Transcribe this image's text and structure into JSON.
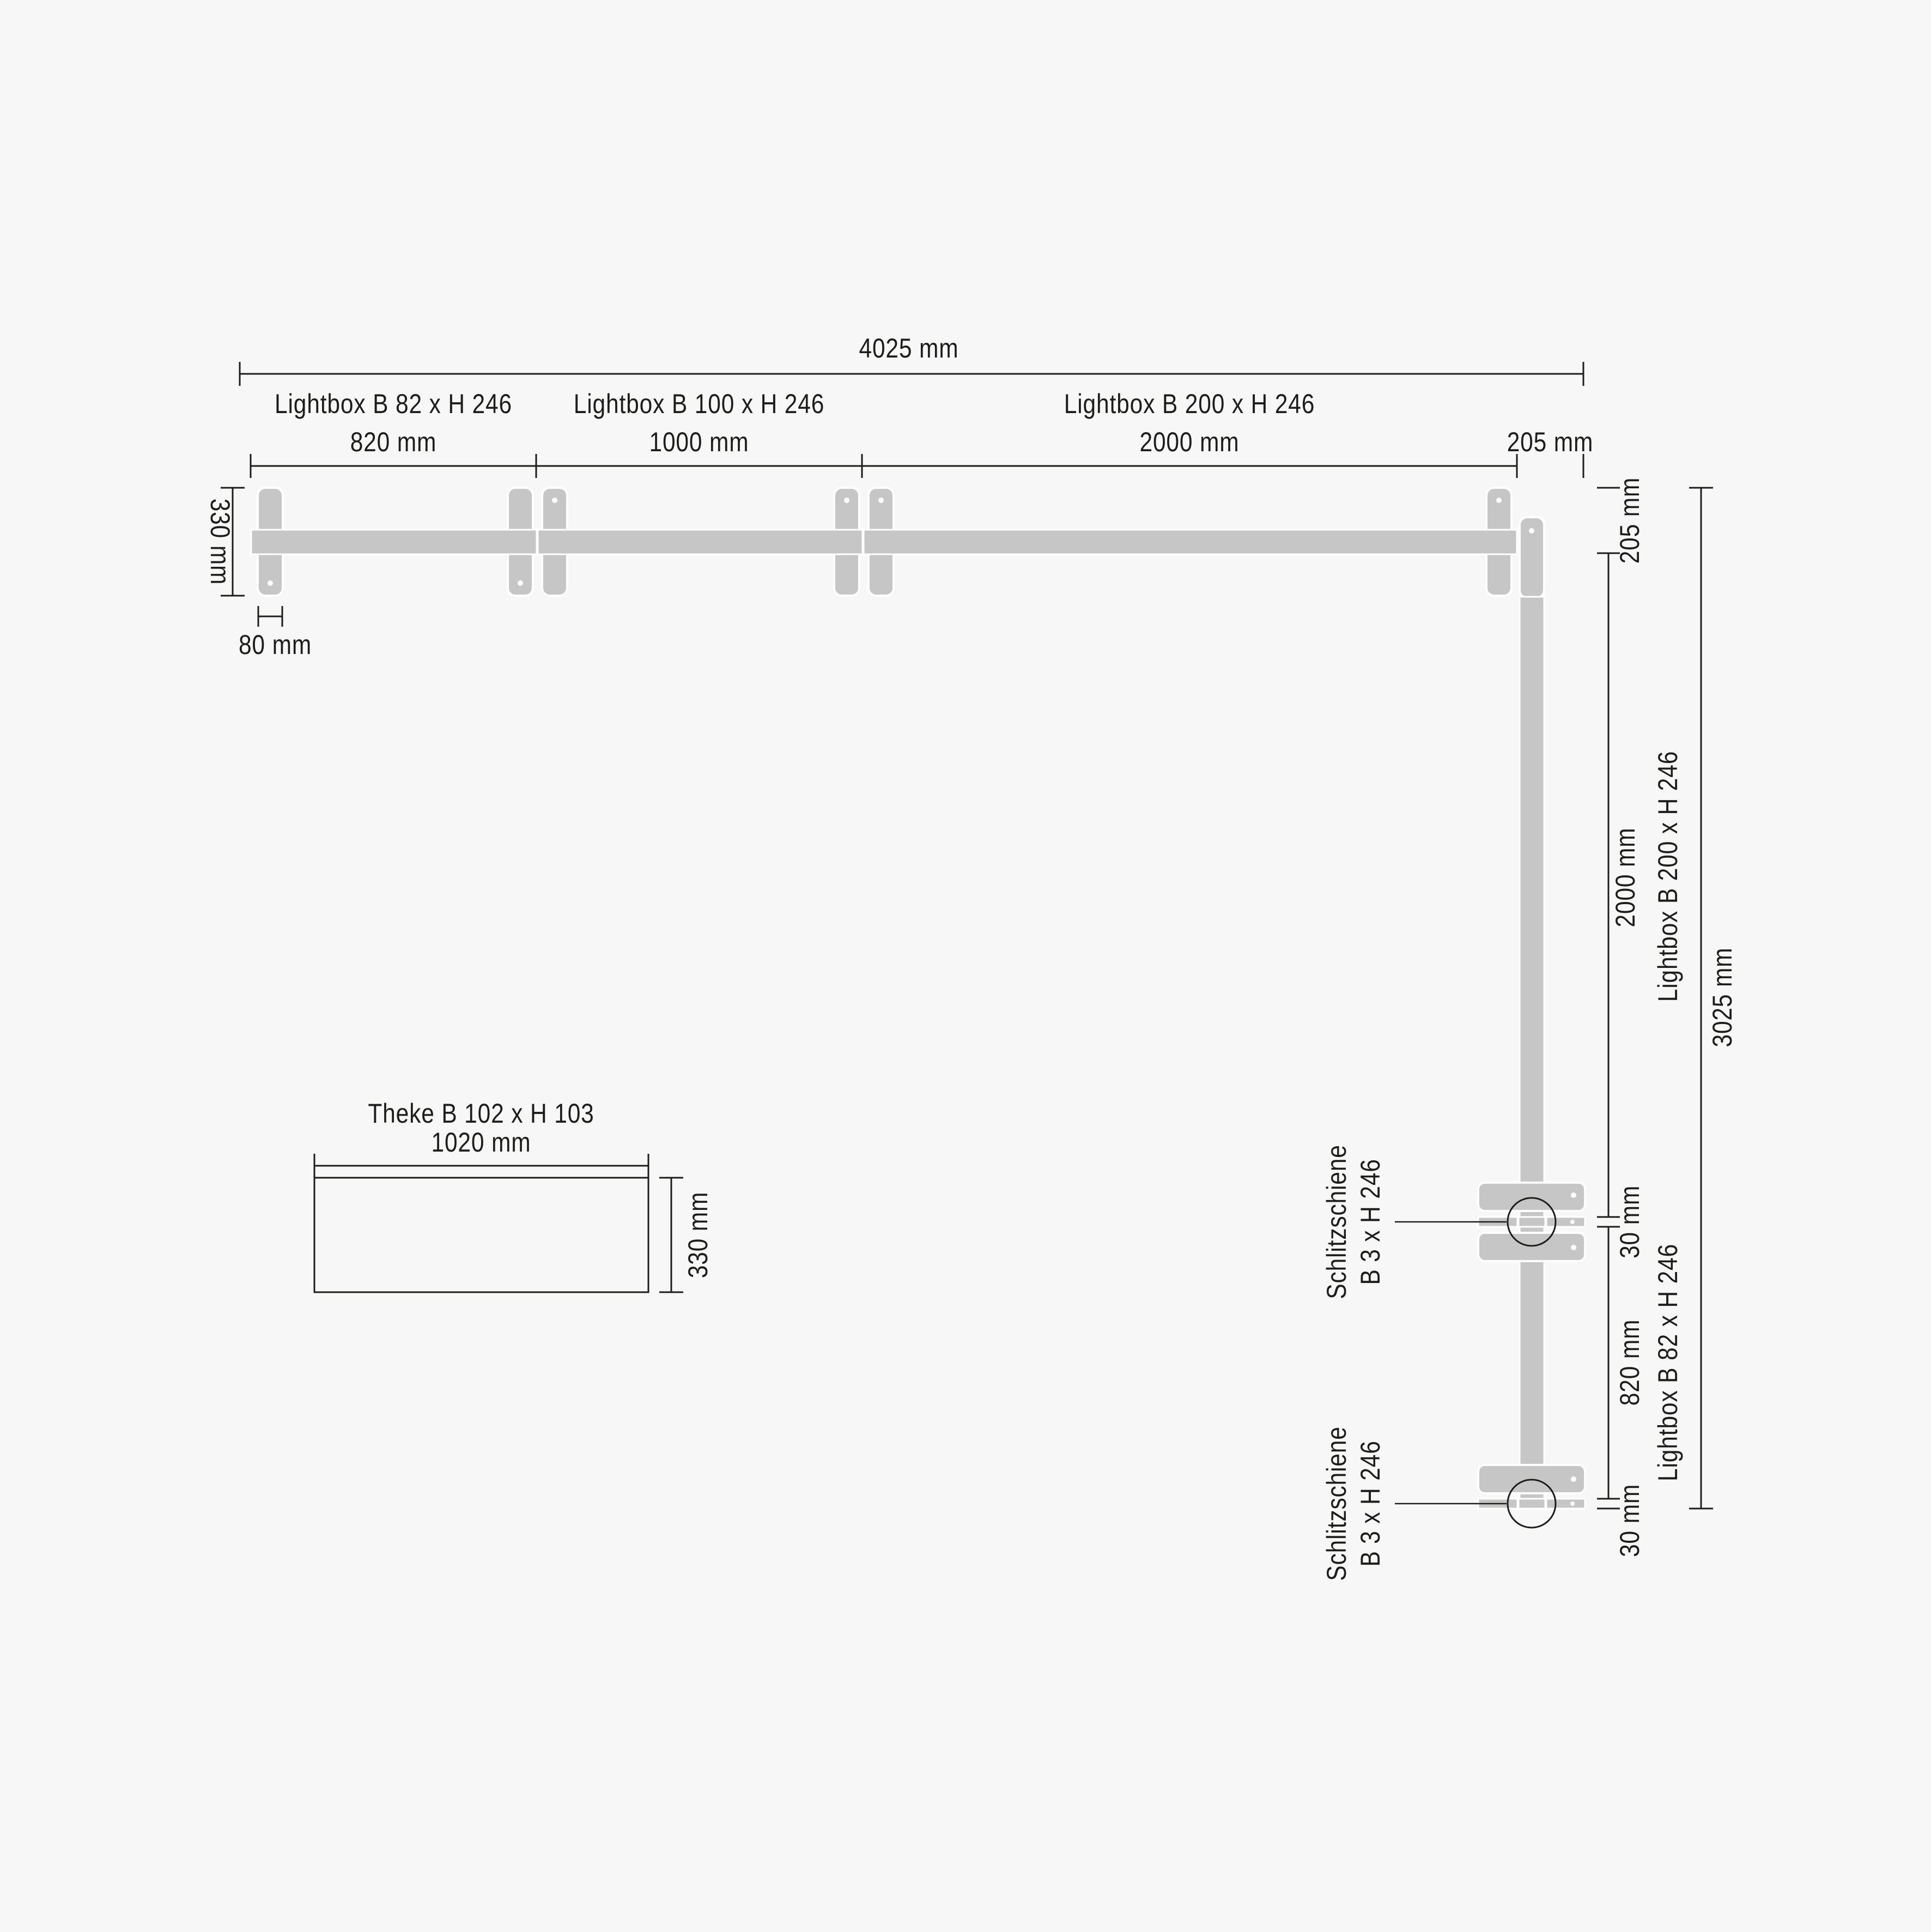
{
  "colors": {
    "background": "#f7f7f7",
    "ink": "#1d1d1b",
    "structure_gray": "#c6c6c6",
    "seam_white": "#ffffff"
  },
  "plan": {
    "overall_width": "4025 mm",
    "top_wall": {
      "segments": [
        {
          "label": "Lightbox B 82 x H 246",
          "width": "820 mm"
        },
        {
          "label": "Lightbox B 100 x H 246",
          "width": "1000 mm"
        },
        {
          "label": "Lightbox B 200 x H 246",
          "width": "2000 mm"
        }
      ],
      "corner_offset": "205 mm",
      "foot_depth": "330 mm",
      "foot_width": "80 mm"
    },
    "right_wall": {
      "top_offset": "205 mm",
      "segments": [
        {
          "label": "Lightbox B 200 x H 246",
          "width": "2000 mm"
        },
        {
          "label": "Lightbox B 82 x H 246",
          "width": "820 mm"
        }
      ],
      "rails": [
        {
          "line1": "Schlitzschiene",
          "line2": "B 3 x H 246",
          "gap": "30 mm"
        },
        {
          "line1": "Schlitzschiene",
          "line2": "B 3 x H 246",
          "gap": "30 mm"
        }
      ],
      "overall_height": "3025 mm"
    },
    "counter": {
      "title": "Theke B 102 x H 103",
      "width": "1020 mm",
      "depth": "330 mm"
    }
  }
}
